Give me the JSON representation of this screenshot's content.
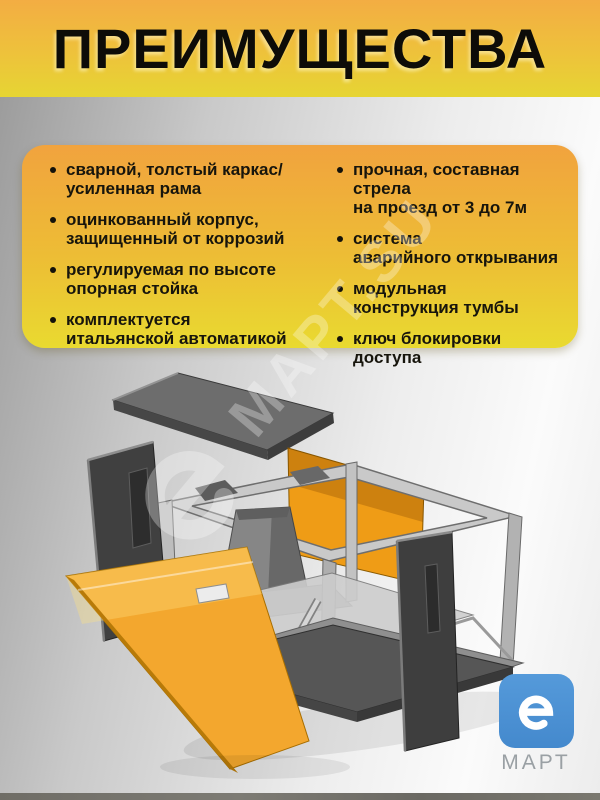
{
  "header": {
    "title": "ПРЕИМУЩЕСТВА"
  },
  "card": {
    "left_items": [
      "сварной, толстый каркас/\nусиленная рама",
      "оцинкованный корпус,\nзащищенный от коррозий",
      "регулируемая по высоте\nопорная стойка",
      "комплектуется\nитальянской автоматикой"
    ],
    "right_items": [
      "прочная, составная стрела\nна проезд от 3 до 7м",
      "система\nаварийного открывания",
      "модульная\nконструкция тумбы",
      "ключ блокировки\nдоступа"
    ]
  },
  "watermark": {
    "text": "МАРТ.SU",
    "icon": "e-logo-icon"
  },
  "illustration": {
    "subject": "exploded-view-barrier-cabinet"
  },
  "logo": {
    "brand": "МАРТ",
    "icon": "e-logo-icon"
  },
  "colors": {
    "header_orange": "#F3AD43",
    "header_yellow": "#E6D533",
    "card_orange": "#F1A33E",
    "card_yellow": "#E9DA30",
    "logo_blue": "#4A8FD3",
    "panel_orange": "#F3A72E",
    "steel_gray": "#C9C9C9",
    "dark_panel_gray": "#3F3F3F",
    "text_black": "#17150C"
  }
}
